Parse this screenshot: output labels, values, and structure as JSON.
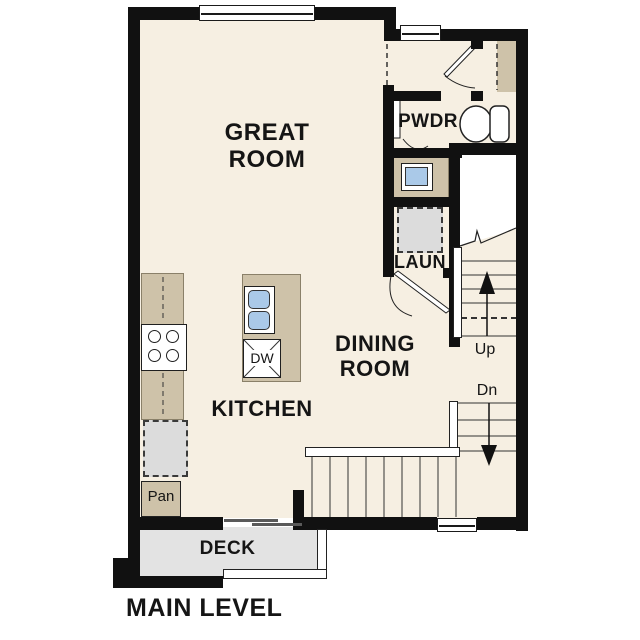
{
  "plan_title": "MAIN LEVEL",
  "labels": {
    "great_room": "GREAT\nROOM",
    "dining_room": "DINING\nROOM",
    "kitchen": "KITCHEN",
    "powder_room": "PWDR",
    "laundry": "LAUN",
    "pantry": "Pan",
    "dishwasher": "DW",
    "deck": "DECK",
    "stairs_up": "Up",
    "stairs_down": "Dn"
  },
  "colors": {
    "background": "#ffffff",
    "floor_cream": "#f6efe2",
    "counter_tan": "#cec2a9",
    "appliance_grey": "#dcdcdc",
    "deck_grey": "#e3e3e3",
    "wall_black": "#111111",
    "sink_blue": "#aac9e8",
    "text_black": "#151515"
  }
}
